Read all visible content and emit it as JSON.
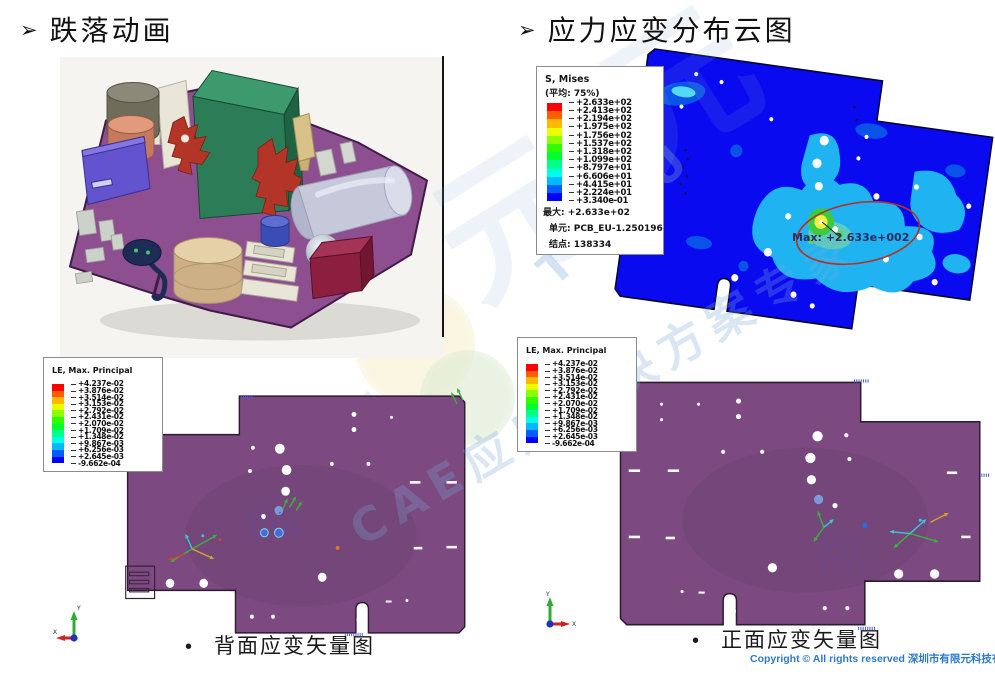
{
  "slide": {
    "bullet": "➢",
    "dot_bullet": "•",
    "left_section_title": "跌落动画",
    "right_section_title": "应力应变分布云图",
    "back_caption": "背面应变矢量图",
    "front_caption": "正面应变矢量图",
    "copyright": "Copyright © All rights reserved 深圳市有限元科技有限公司",
    "watermark": {
      "glyph_large": "元",
      "brand": "TEMU",
      "tagline": "CAE应用解决方案专家"
    }
  },
  "stress_legend": {
    "title": "S, Mises",
    "subtitle": "(平均: 75%)",
    "tick_labels": [
      "+2.633e+02",
      "+2.413e+02",
      "+2.194e+02",
      "+1.975e+02",
      "+1.756e+02",
      "+1.537e+02",
      "+1.318e+02",
      "+1.099e+02",
      "+8.797e+01",
      "+6.606e+01",
      "+4.415e+01",
      "+2.224e+01",
      "+3.340e-01"
    ],
    "max_line": "最大: +2.633e+02",
    "element_line": "单元: PCB_EU-1.250196",
    "node_line": "结点: 138334"
  },
  "strain_legend": {
    "title": "LE, Max. Principal",
    "tick_labels": [
      "+4.237e-02",
      "+3.876e-02",
      "+3.514e-02",
      "+3.153e-02",
      "+2.792e-02",
      "+2.431e-02",
      "+2.070e-02",
      "+1.709e-02",
      "+1.348e-02",
      "+9.867e-03",
      "+6.256e-03",
      "+2.645e-03",
      "-9.662e-04"
    ]
  },
  "stress_plot": {
    "max_annotation": "Max: +2.633e+002"
  },
  "triad": {
    "x_label": "X",
    "y_label": "Y"
  },
  "palette": {
    "spectrum": [
      "#ff0000",
      "#ff5d00",
      "#ffb900",
      "#e8ff00",
      "#8bff00",
      "#2eff00",
      "#00ff2e",
      "#00ff8b",
      "#00ffe8",
      "#00b9ff",
      "#005dff",
      "#0000ff"
    ],
    "board_purple": "#7c4a80",
    "cad_board_purple": "#8d4f90",
    "contour_blue": "#0a0af0",
    "contour_mid": "#0a52e8",
    "contour_cyan": "#1fb3f2",
    "hotspot_green": "#3fc93f",
    "hotspot_yellow": "#eff23c",
    "annotation_red": "#b03228",
    "copyright_blue": "#2e79c8",
    "watermark_blue": "#7aa9d8"
  }
}
